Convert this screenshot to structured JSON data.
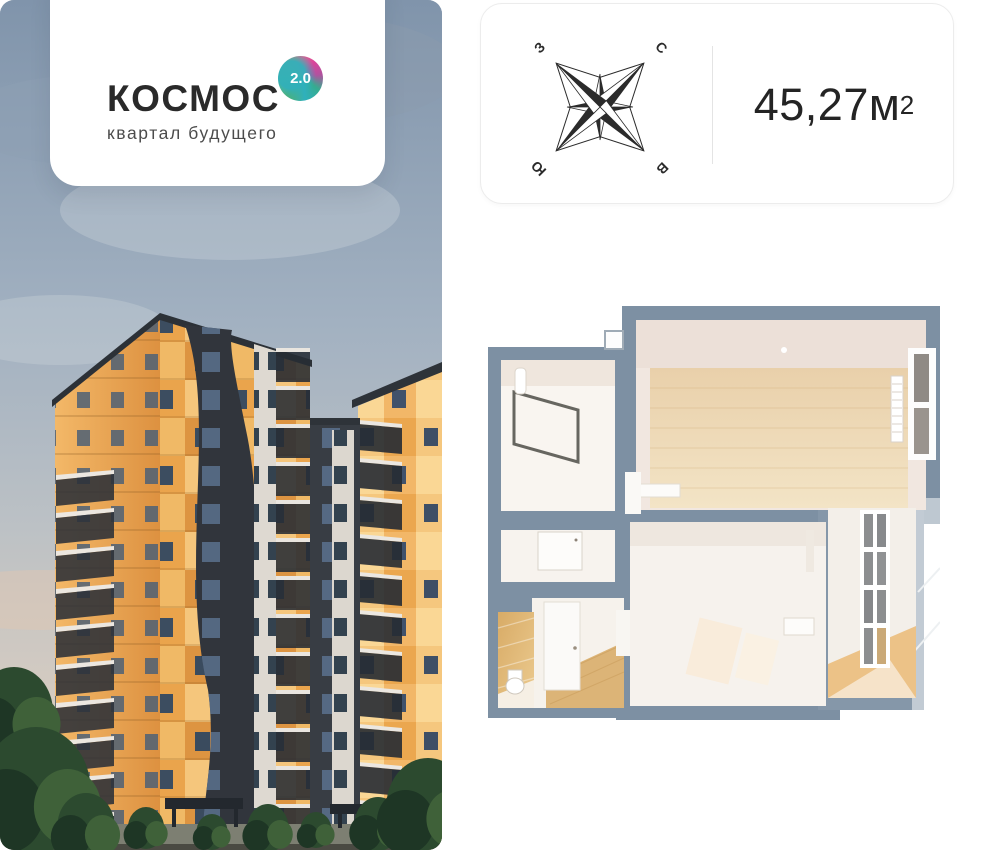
{
  "logo_card": {
    "title": "КОСМОС",
    "badge": "2.0",
    "subtitle": "квартал будущего"
  },
  "info_card": {
    "area_value": "45,27",
    "area_unit": "м",
    "area_exponent": "2",
    "compass": {
      "north": "С",
      "east": "В",
      "south": "Ю",
      "west": "З"
    }
  },
  "floor_plan": {
    "wall_color": "#7d90a3",
    "room_fill": "#f7f3ee",
    "wood_floor": "#ecd6b4",
    "tile_wall": "#ddb172",
    "balcony_glass": "#8c8e90"
  },
  "photo": {
    "sky_top": "#8094ab",
    "sunset_glow": "#e9d5bc",
    "facade_orange": "#eaa44c",
    "facade_cream": "#f5c67c",
    "facade_dark": "#31353c",
    "tree_green": "#2c4a2f"
  }
}
